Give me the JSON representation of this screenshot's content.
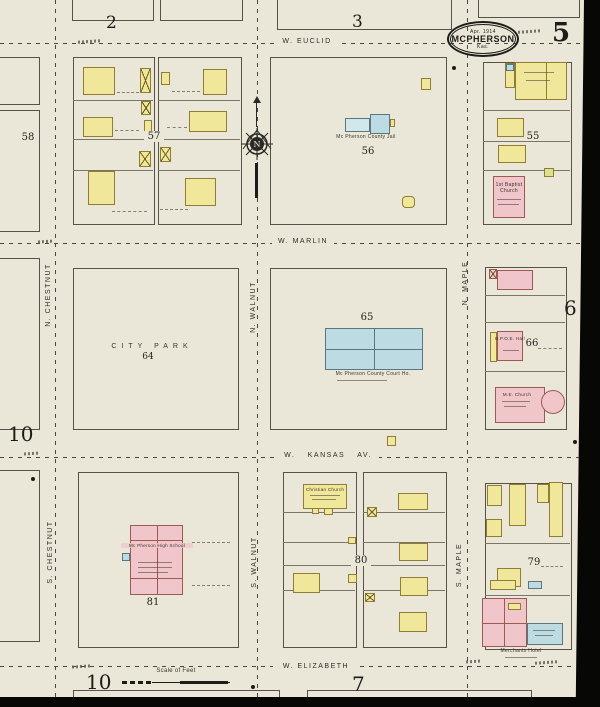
{
  "stamp": {
    "date": "Apr. 1914",
    "city": "McPherson",
    "state": "Kas."
  },
  "sheet": {
    "number": "5",
    "neighbor_top_left": "2",
    "neighbor_top_center": "3",
    "neighbor_right": "6",
    "neighbor_left": "10",
    "neighbor_bottom_left": "10",
    "neighbor_bottom_center": "7"
  },
  "streets": {
    "w_euclid": "W. EUCLID",
    "w_marlin": "W. MARLIN",
    "w_kansas": "W. KANSAS AV.",
    "w_elizabeth": "W. ELIZABETH",
    "n_chestnut": "N. CHESTNUT",
    "s_chestnut": "S. CHESTNUT",
    "n_walnut": "N. WALNUT",
    "s_walnut": "S. WALNUT",
    "n_maple": "N. MAPLE",
    "s_maple": "S. MAPLE"
  },
  "blocks": {
    "b55": "55",
    "b56": "56",
    "b57": "57",
    "b58": "58",
    "b64": "64",
    "b65": "65",
    "b66": "66",
    "b79": "79",
    "b80": "80",
    "b81": "81"
  },
  "buildings": {
    "county_jail": "Mc Pherson County Jail",
    "county_court_house": "Mc Pherson County Court Ho.",
    "city_park": "City Park",
    "first_baptist_church": "1st Baptist Church",
    "bpoe_hall": "B.P.O.E. Hall",
    "me_church": "M.E. Church",
    "christian_church": "Christian Church",
    "high_school": "Mc Pherson High School",
    "merchants_hotel": "Merchants Hotel"
  },
  "scale": {
    "label": "Scale of Feet"
  },
  "compass": {
    "north": "N"
  },
  "colors": {
    "paper": "#eae7d8",
    "frame_yellow": "#f0e79b",
    "brick_pink": "#f0c6ca",
    "stone_blue": "#bcdbe2",
    "ink": "#2e2c26"
  }
}
